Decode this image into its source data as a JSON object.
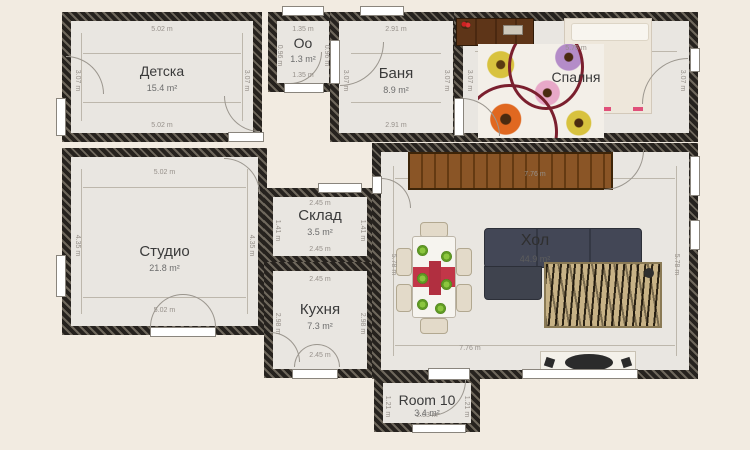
{
  "app": {
    "view_title": "Floor plan"
  },
  "palette": {
    "background": "#f2ebe1",
    "floor": "#e9e6e1",
    "wall_dark": "#26221e",
    "wall_light": "#6e675c",
    "dimension_text": "#96908a",
    "room_label": "#3a3a3a",
    "sofa": "#3f434e",
    "wood": "#7a4a1e",
    "rug_tan": "#c7b286",
    "runner_red": "#c23648",
    "plate_green": "#5f9a23"
  },
  "rooms": [
    {
      "label": "Детска",
      "area": "15.4 m²",
      "dim_top": "5.02 m",
      "dim_bottom": "5.02 m",
      "dim_left": "3.07 m",
      "dim_right": "3.07 m"
    },
    {
      "label": "Оо",
      "area": "1.3 m²",
      "dim_top": "1.35 m",
      "dim_bottom": "1.35 m",
      "dim_left": "0.96 m",
      "dim_right": "0.96 m"
    },
    {
      "label": "Баня",
      "area": "8.9 m²",
      "dim_top": "2.91 m",
      "dim_bottom": "2.91 m",
      "dim_left": "3.07 m",
      "dim_right": "3.07 m"
    },
    {
      "label": "Спалня",
      "dim_top": "5.75 m",
      "dim_left": "3.07 m",
      "dim_right": "3.07 m"
    },
    {
      "label": "Студио",
      "area": "21.8 m²",
      "dim_top": "5.02 m",
      "dim_bottom": "5.02 m",
      "dim_left": "4.35 m",
      "dim_right": "4.35 m"
    },
    {
      "label": "Склад",
      "area": "3.5 m²",
      "dim_top": "2.45 m",
      "dim_bottom": "2.45 m",
      "dim_left": "1.41 m",
      "dim_right": "1.41 m"
    },
    {
      "label": "Кухня",
      "area": "7.3 m²",
      "dim_top": "2.45 m",
      "dim_bottom": "2.45 m",
      "dim_left": "2.98 m",
      "dim_right": "2.98 m"
    },
    {
      "label": "Хол",
      "area": "44.9 m²",
      "dim_top": "7.76 m",
      "dim_bottom": "7.76 m",
      "dim_left": "5.78 m",
      "dim_right": "5.78 m"
    },
    {
      "label": "Room 10",
      "area": "3.4 m²",
      "dim_mid": "2.83 m",
      "dim_left": "1.21 m",
      "dim_right": "1.21 m"
    }
  ],
  "furniture": [
    {
      "name": "sideboard",
      "room": "Хол"
    },
    {
      "name": "dining-table",
      "room": "Хол"
    },
    {
      "name": "dining-chairs",
      "room": "Хол",
      "count": 6
    },
    {
      "name": "corner-sofa",
      "room": "Хол"
    },
    {
      "name": "zebra-rug",
      "room": "Хол"
    },
    {
      "name": "tv-console",
      "room": "Хол"
    },
    {
      "name": "dresser",
      "room": "Спалня"
    },
    {
      "name": "bed",
      "room": "Спалня"
    },
    {
      "name": "flower-rug",
      "room": "Спалня"
    }
  ]
}
